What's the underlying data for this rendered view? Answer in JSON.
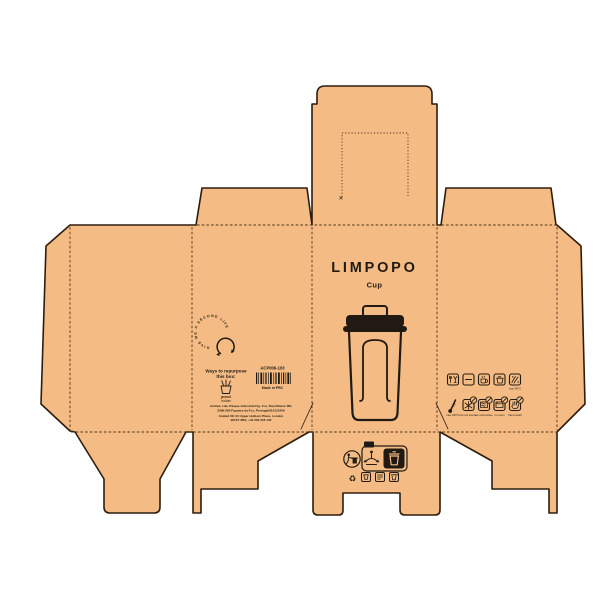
{
  "colors": {
    "background": "#ffffff",
    "kraft": "#f4bc84",
    "cut_line": "#2e1d0e",
    "fold_line": "#50351a",
    "ink": "#211a12"
  },
  "brand": {
    "name": "LIMPOPO",
    "product": "Cup"
  },
  "info_panel": {
    "second_life": "GIVE ME A SECOND LIFE",
    "repurpose_heading_1": "Ways to repurpose",
    "repurpose_heading_2": "this box:",
    "idea_line_1": "pencil",
    "idea_line_2": "holder",
    "sku": "ACP006-103",
    "made_in": "Made in PRC",
    "address_1": "Amited, Lda. Parque Industrial Fig. Foz, Rua Bilston RD,",
    "address_2": "3090-380 Figueira da Foz, Portugal/910123456",
    "address_3": "Amited UK 31 Upper Holborn Place, London",
    "address_4": "WC1V 6BX, +44 203 318 102"
  },
  "care_panel": {
    "row1_label_5": "max 90°C",
    "row2_labels": [
      "max 100°C",
      "do not freeze",
      "no microwave",
      "no oven",
      "hand wash"
    ]
  },
  "recycling": {
    "fr_tag": "FR"
  },
  "icons": {
    "mobius": "♻"
  },
  "marks": {
    "cross": "✕"
  }
}
